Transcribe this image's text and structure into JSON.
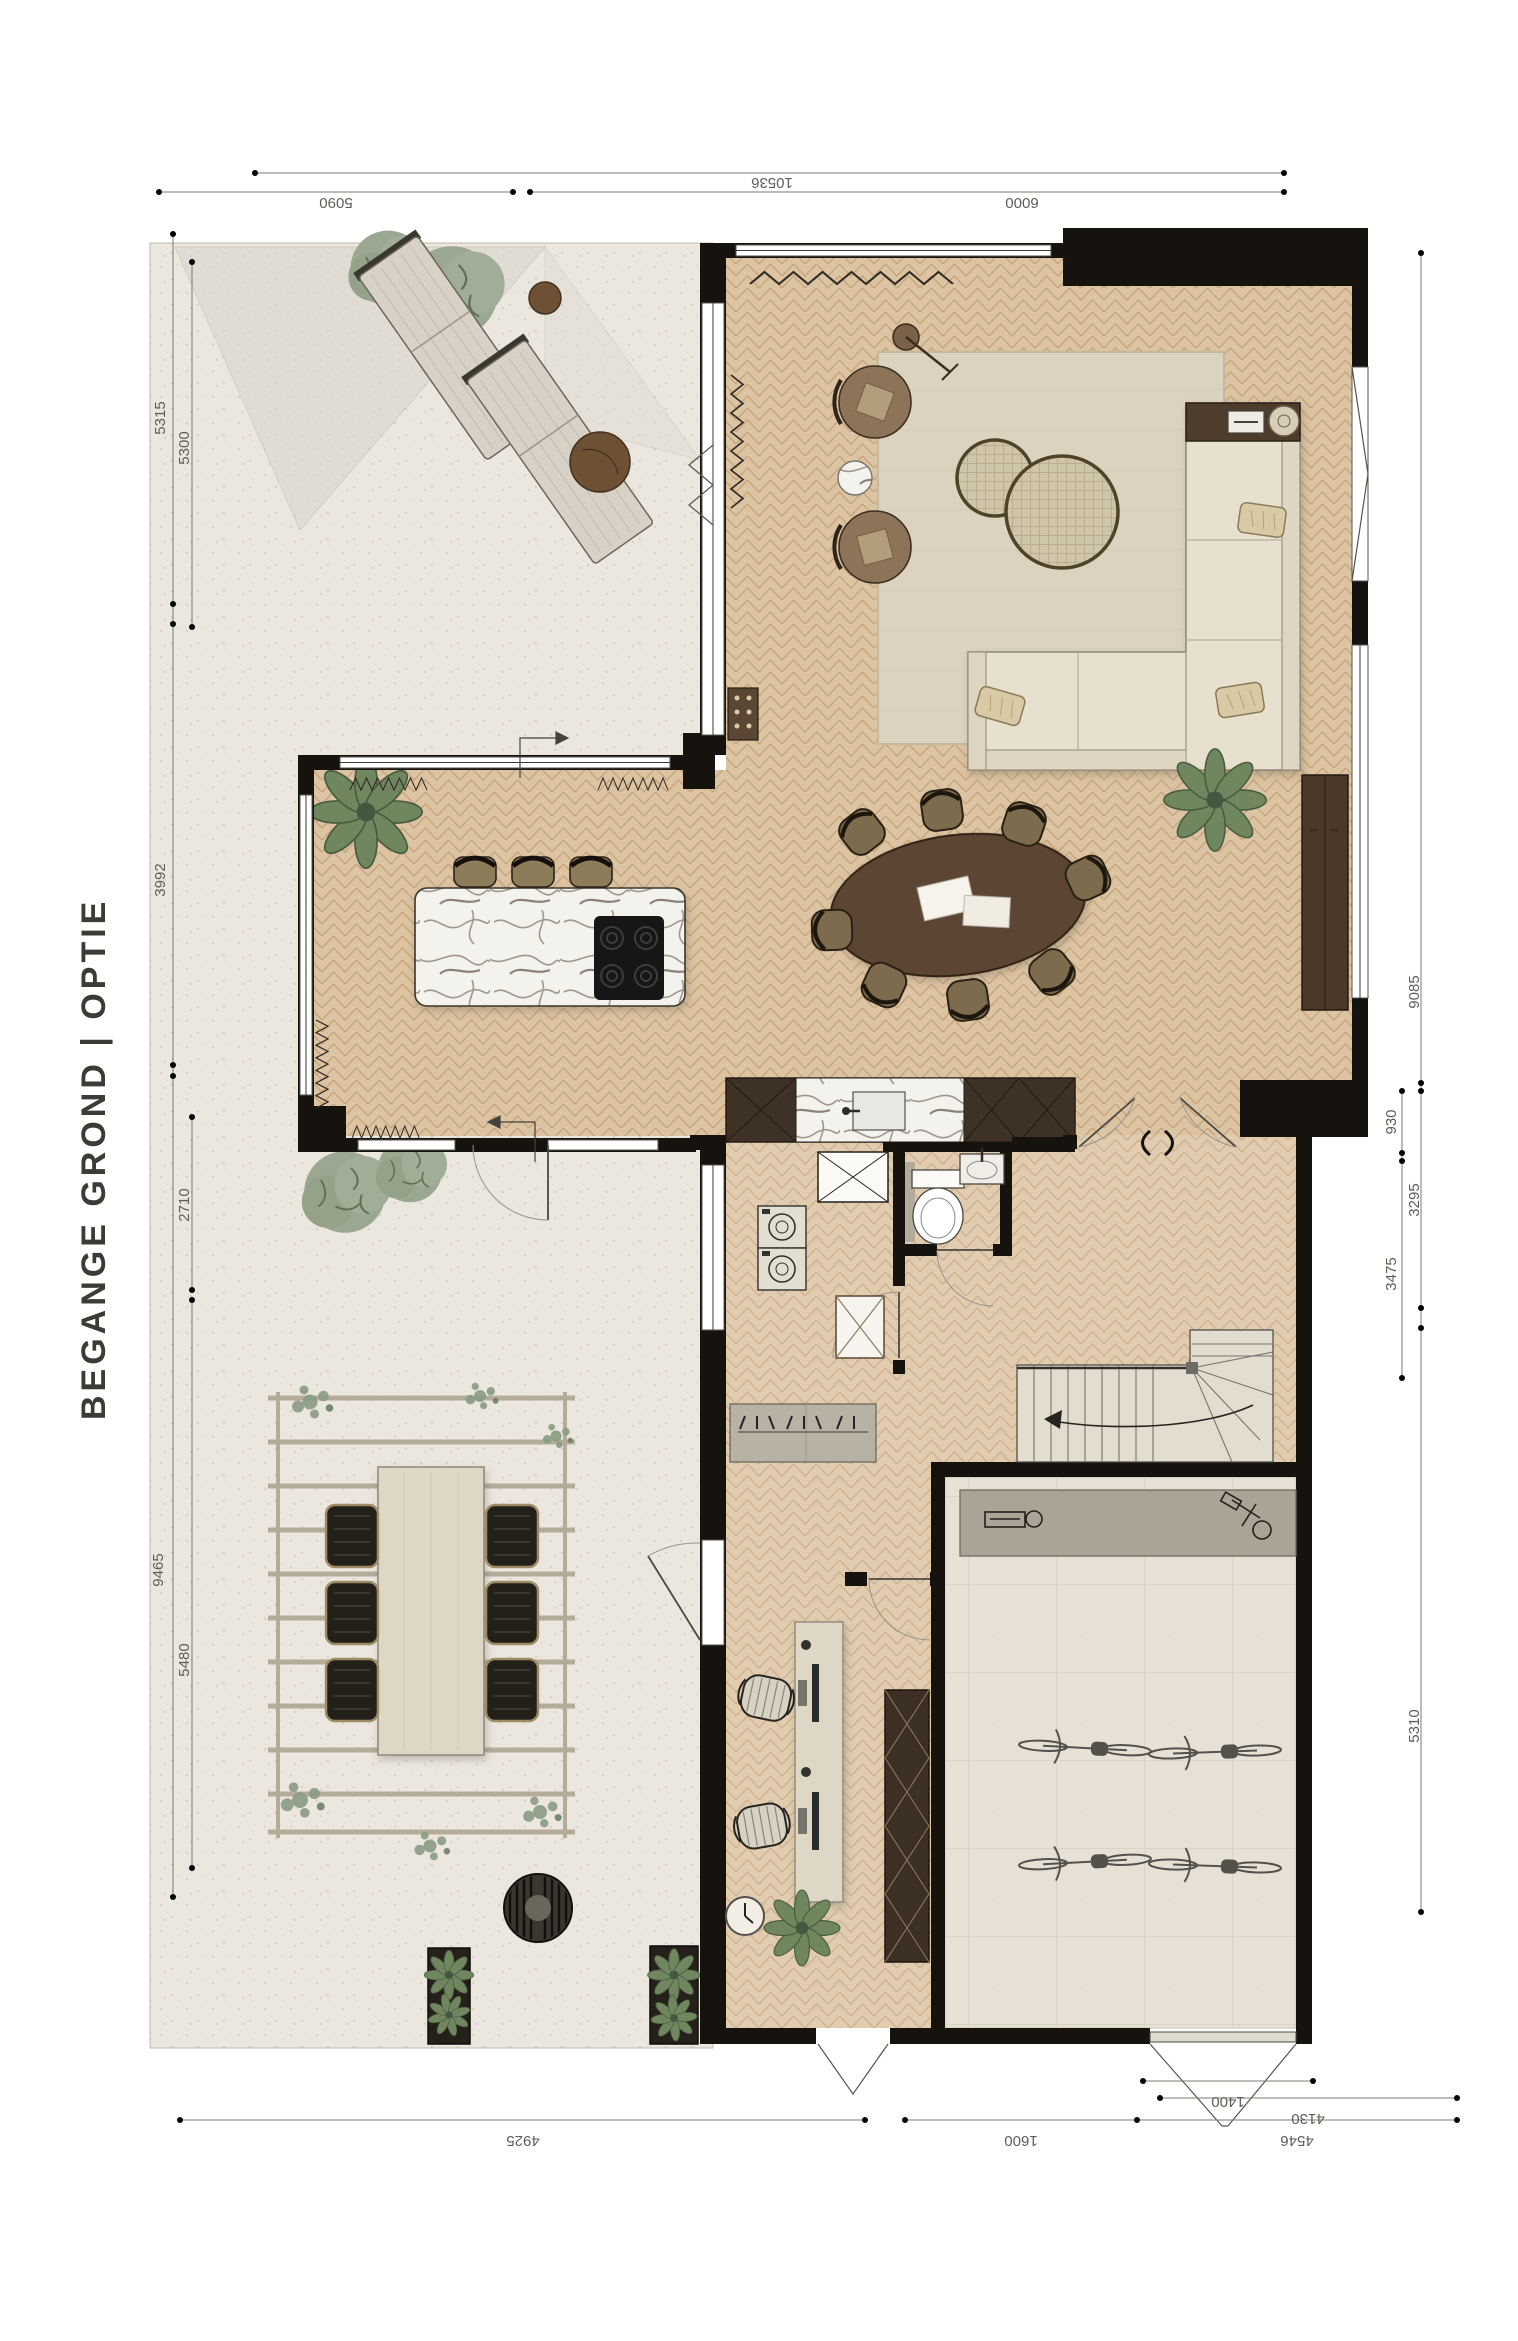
{
  "title": "BEGANGE GROND | OPTIE",
  "drawing_type": "ground-floor interior plan",
  "dims": {
    "top": [
      "10536",
      "5090",
      "6000"
    ],
    "left": [
      "5315",
      "5300",
      "3992",
      "2710",
      "9465",
      "5480"
    ],
    "right": [
      "9085",
      "930",
      "3295",
      "3475",
      "5310"
    ],
    "bottom": [
      "4925",
      "1600",
      "1400",
      "4130",
      "4546"
    ]
  },
  "palette": {
    "wall": "#16130f",
    "wood_floor": "#dcc3a1",
    "wood_joint": "#c6a57d",
    "terrace_floor": "#ebe7de",
    "concrete_floor": "#e7e1d5",
    "marble": "#f4f2ed",
    "dark_wood": "#4a392a",
    "sofa": "#e7e0ce",
    "rug": "#dbd3bf",
    "foliage": "#99a88f",
    "dimension_text": "#5f5d57",
    "title_text": "#3d3b36"
  },
  "icons": {
    "door-swing": "quarter-circle arc with leaf line",
    "casement-window": "v-wedge",
    "radiator": "zigzag line",
    "stair-direction": "curved arrow",
    "section-marker": "arrow polyline",
    "cooktop": "four burner circles",
    "sink": "basin rectangle with tap",
    "toilet": "tank and bowl",
    "washer": "square with drum circle",
    "dryer": "square with drum circle",
    "coat-hooks": "slash marks on rail",
    "wall-clock": "circle with hands",
    "fire-bowl": "striped circle",
    "bicycle": "two ellipse wheels with frame"
  }
}
